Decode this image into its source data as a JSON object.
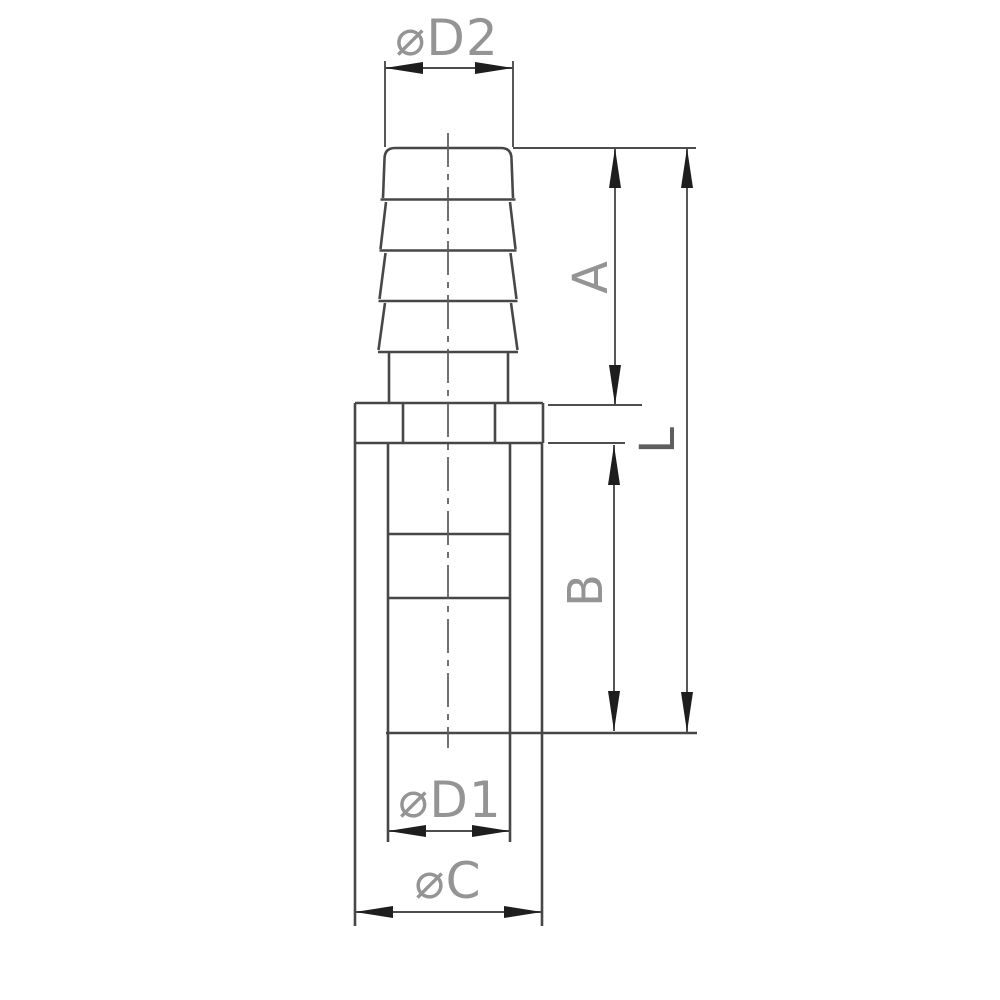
{
  "drawing": {
    "description": "Technical line drawing of a barbed hose adapter fitting shown in side view with dimension annotations",
    "view": "orthographic side view, white background",
    "part_features": [
      "hose barb with four ridges",
      "hex flange collar",
      "cylindrical socket body",
      "internal bore step",
      "vertical dash-dot centerline"
    ],
    "dimension_labels": {
      "d2": "⌀D2",
      "a": "A",
      "l": "L",
      "b": "B",
      "d1": "⌀D1",
      "c": "⌀C"
    },
    "dimension_meanings": {
      "d2": "barb outer diameter (top)",
      "a": "barb section length (top of barb to flange top)",
      "l": "overall length (top of barb to socket bottom)",
      "b": "socket body length (flange bottom to bore bottom)",
      "d1": "socket inner diameter",
      "c": "body outer diameter"
    },
    "colors": {
      "background": "#ffffff",
      "outline": "#474747",
      "dimension_line": "#4d4d4d",
      "arrow": "#1e1e1e",
      "label_gray": "#949494",
      "label_dark": "#5e5e5e",
      "centerline": "#5a5a5a"
    }
  }
}
